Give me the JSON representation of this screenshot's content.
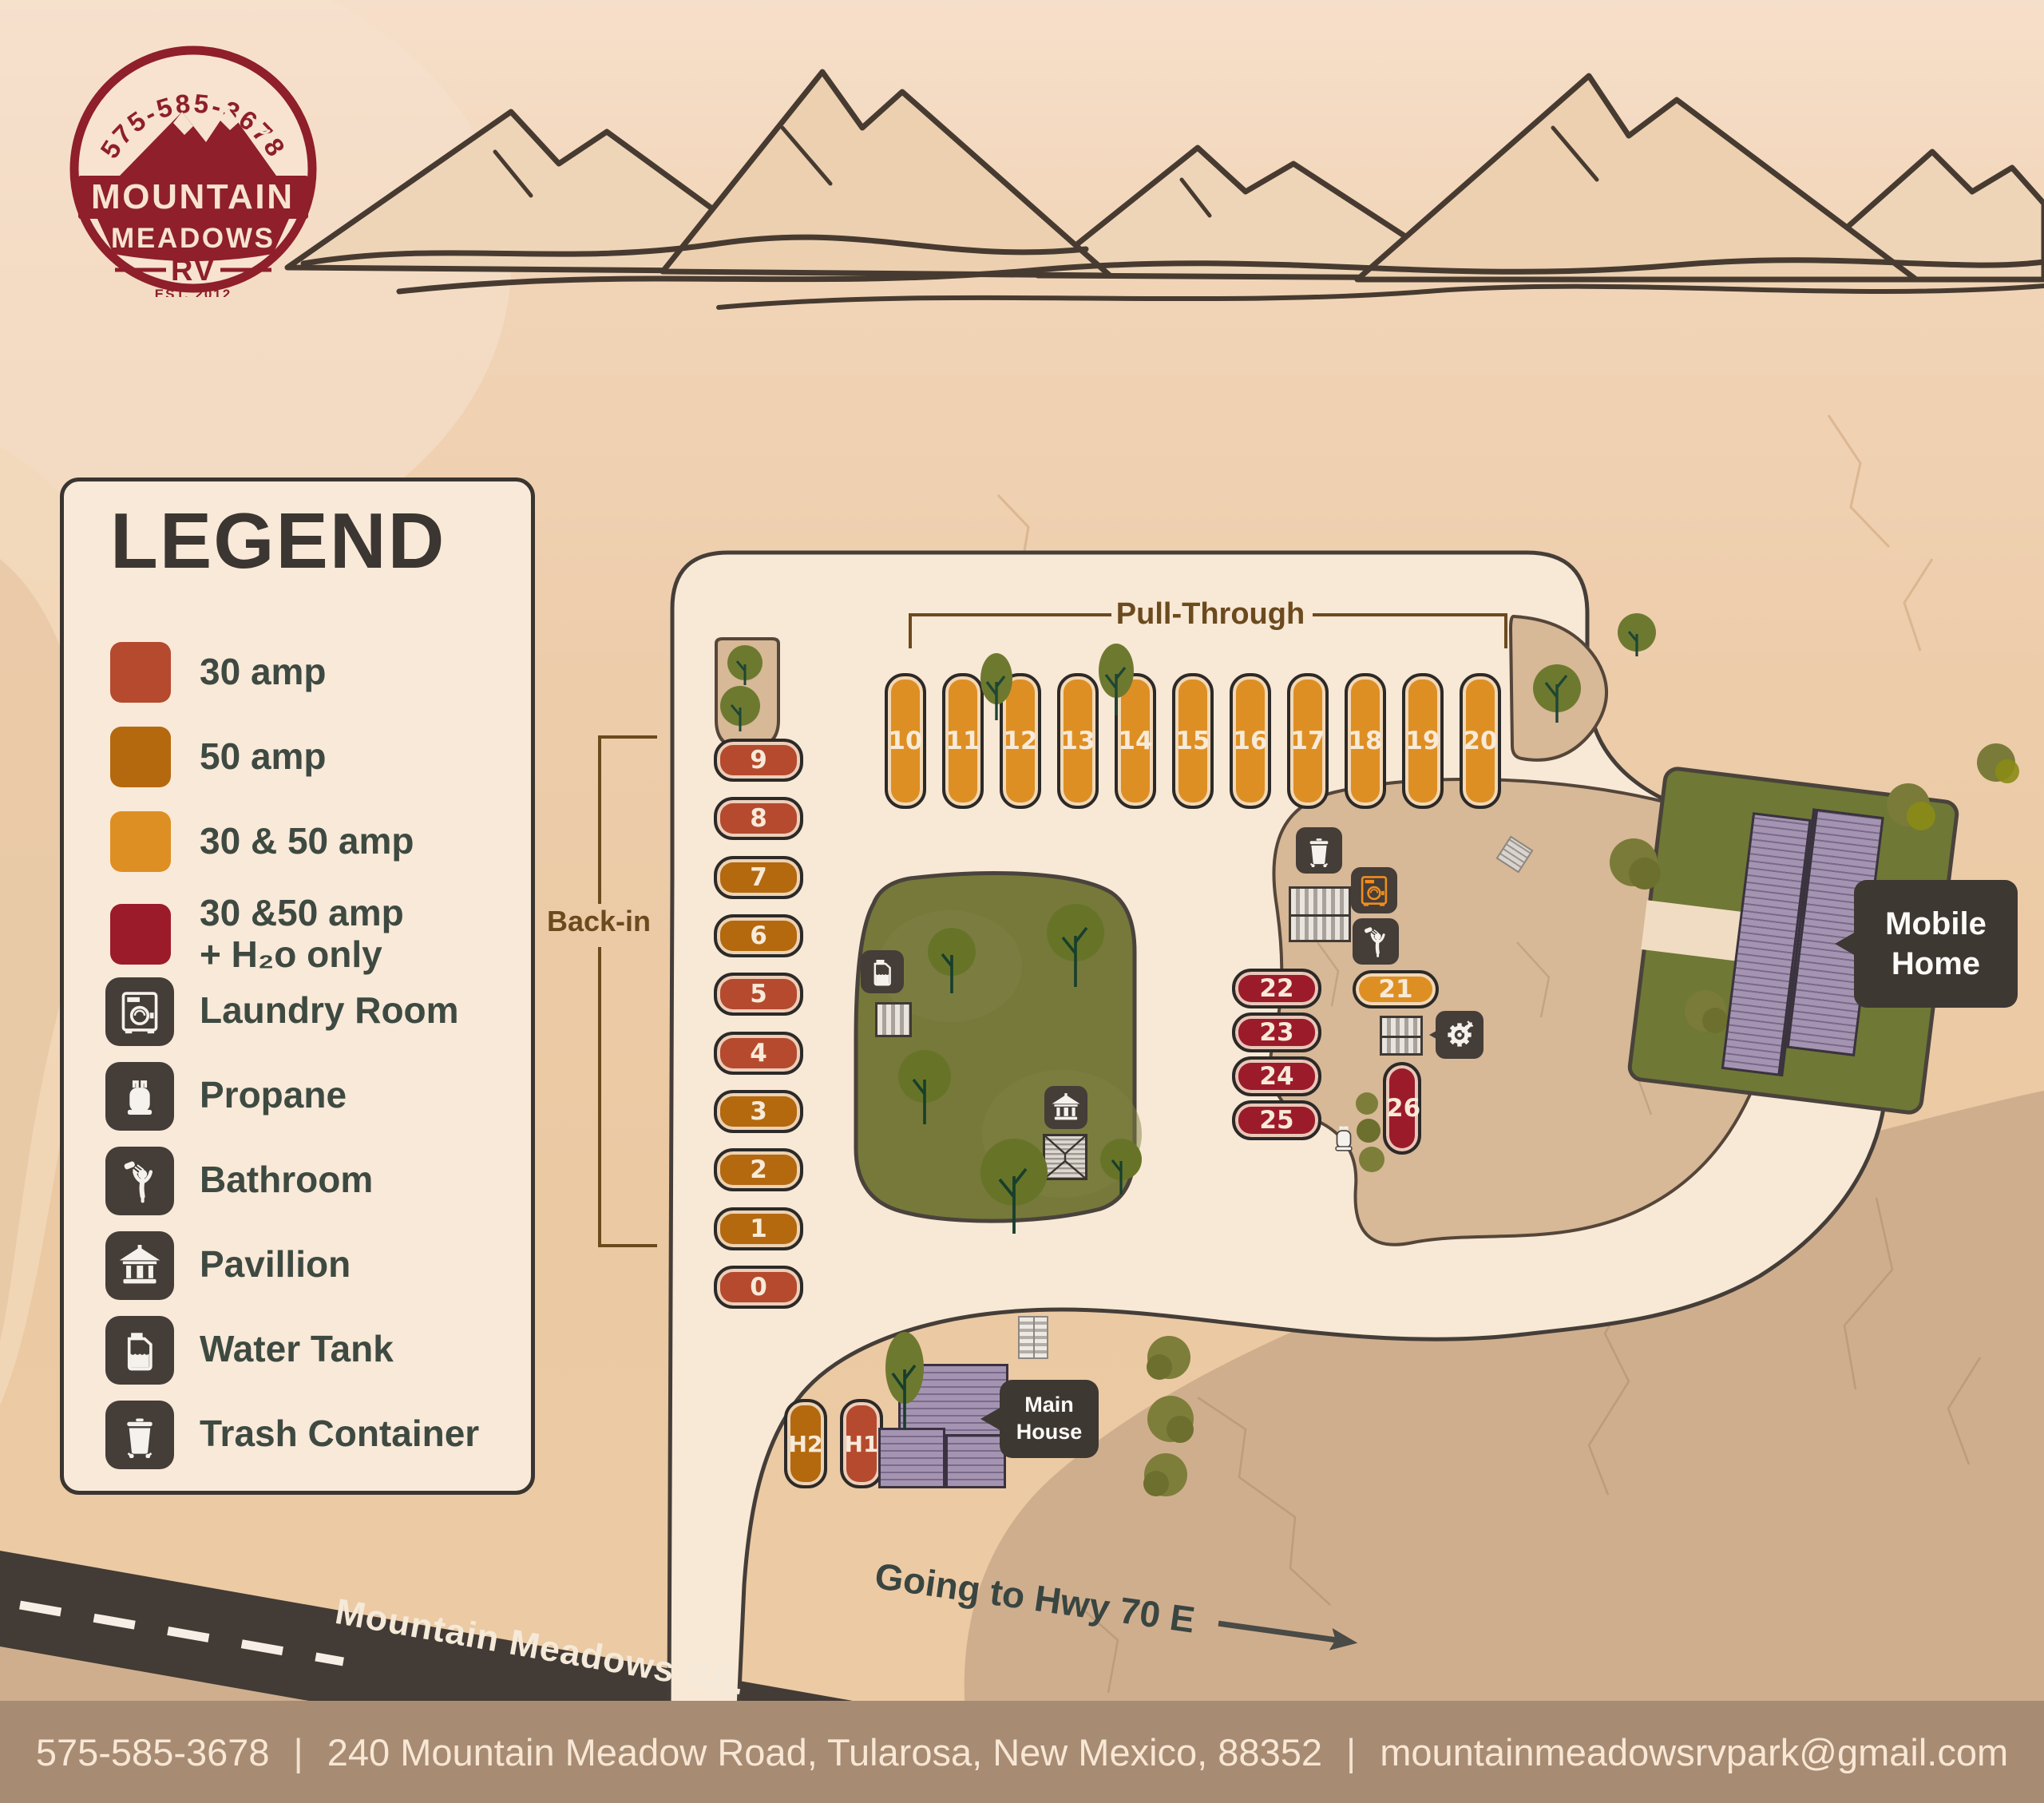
{
  "logo": {
    "phone": "575-585-3678",
    "title_line1": "MOUNTAIN",
    "title_line2": "MEADOWS",
    "title_line3": "RV",
    "established": "EST. 2012"
  },
  "colors": {
    "amp30": "#b54a2f",
    "amp50": "#b4690f",
    "amp3050": "#de8f24",
    "amp3050h2o": "#9c1b2b",
    "icon_background": "#443d38",
    "road_cream": "#f8e8d6",
    "logo_red": "#8e1f2b"
  },
  "legend": {
    "title": "LEGEND",
    "items": [
      {
        "id": "amp30",
        "kind": "swatch",
        "label": "30 amp",
        "swatch": "#b54a2f"
      },
      {
        "id": "amp50",
        "kind": "swatch",
        "label": "50 amp",
        "swatch": "#b4690f"
      },
      {
        "id": "amp3050",
        "kind": "swatch",
        "label": "30 & 50 amp",
        "swatch": "#de8f24"
      },
      {
        "id": "amp3050h2o",
        "kind": "swatch",
        "label": "30 &50 amp",
        "label2": "+ H₂o only",
        "swatch": "#9c1b2b"
      },
      {
        "id": "laundry",
        "kind": "icon",
        "label": "Laundry Room"
      },
      {
        "id": "propane",
        "kind": "icon",
        "label": "Propane"
      },
      {
        "id": "bathroom",
        "kind": "icon",
        "label": "Bathroom"
      },
      {
        "id": "pavillion",
        "kind": "icon",
        "label": "Pavillion"
      },
      {
        "id": "water_tank",
        "kind": "icon",
        "label": "Water Tank"
      },
      {
        "id": "trash",
        "kind": "icon",
        "label": "Trash Container"
      }
    ]
  },
  "map": {
    "pull_through_label": "Pull-Through",
    "back_in_label": "Back-in",
    "pull_through_sites": [
      {
        "id": "10",
        "type": "amp3050"
      },
      {
        "id": "11",
        "type": "amp3050"
      },
      {
        "id": "12",
        "type": "amp3050"
      },
      {
        "id": "13",
        "type": "amp3050"
      },
      {
        "id": "14",
        "type": "amp3050"
      },
      {
        "id": "15",
        "type": "amp3050"
      },
      {
        "id": "16",
        "type": "amp3050"
      },
      {
        "id": "17",
        "type": "amp3050"
      },
      {
        "id": "18",
        "type": "amp3050"
      },
      {
        "id": "19",
        "type": "amp3050"
      },
      {
        "id": "20",
        "type": "amp3050"
      }
    ],
    "back_in_sites": [
      {
        "id": "9",
        "type": "amp30"
      },
      {
        "id": "8",
        "type": "amp30"
      },
      {
        "id": "7",
        "type": "amp50"
      },
      {
        "id": "6",
        "type": "amp50"
      },
      {
        "id": "5",
        "type": "amp30"
      },
      {
        "id": "4",
        "type": "amp30"
      },
      {
        "id": "3",
        "type": "amp50"
      },
      {
        "id": "2",
        "type": "amp50"
      },
      {
        "id": "1",
        "type": "amp50"
      },
      {
        "id": "0",
        "type": "amp30"
      }
    ],
    "area_sites": [
      {
        "id": "22",
        "type": "amp3050h2o"
      },
      {
        "id": "23",
        "type": "amp3050h2o"
      },
      {
        "id": "24",
        "type": "amp3050h2o"
      },
      {
        "id": "25",
        "type": "amp3050h2o"
      },
      {
        "id": "21",
        "type": "amp3050"
      },
      {
        "id": "26",
        "type": "amp3050h2o"
      }
    ],
    "house_sites": [
      {
        "id": "H2",
        "type": "amp50"
      },
      {
        "id": "H1",
        "type": "amp30"
      }
    ],
    "mobile_home_label": [
      "Mobile",
      "Home"
    ],
    "main_house_label": [
      "Main",
      "House"
    ],
    "road_name": "Mountain Meadows Rd.",
    "highway_note": "Going to Hwy 70 E"
  },
  "footer": {
    "phone": "575-585-3678",
    "separator": "|",
    "address": "240 Mountain Meadow Road, Tularosa, New Mexico, 88352",
    "email": "mountainmeadowsrvpark@gmail.com"
  }
}
